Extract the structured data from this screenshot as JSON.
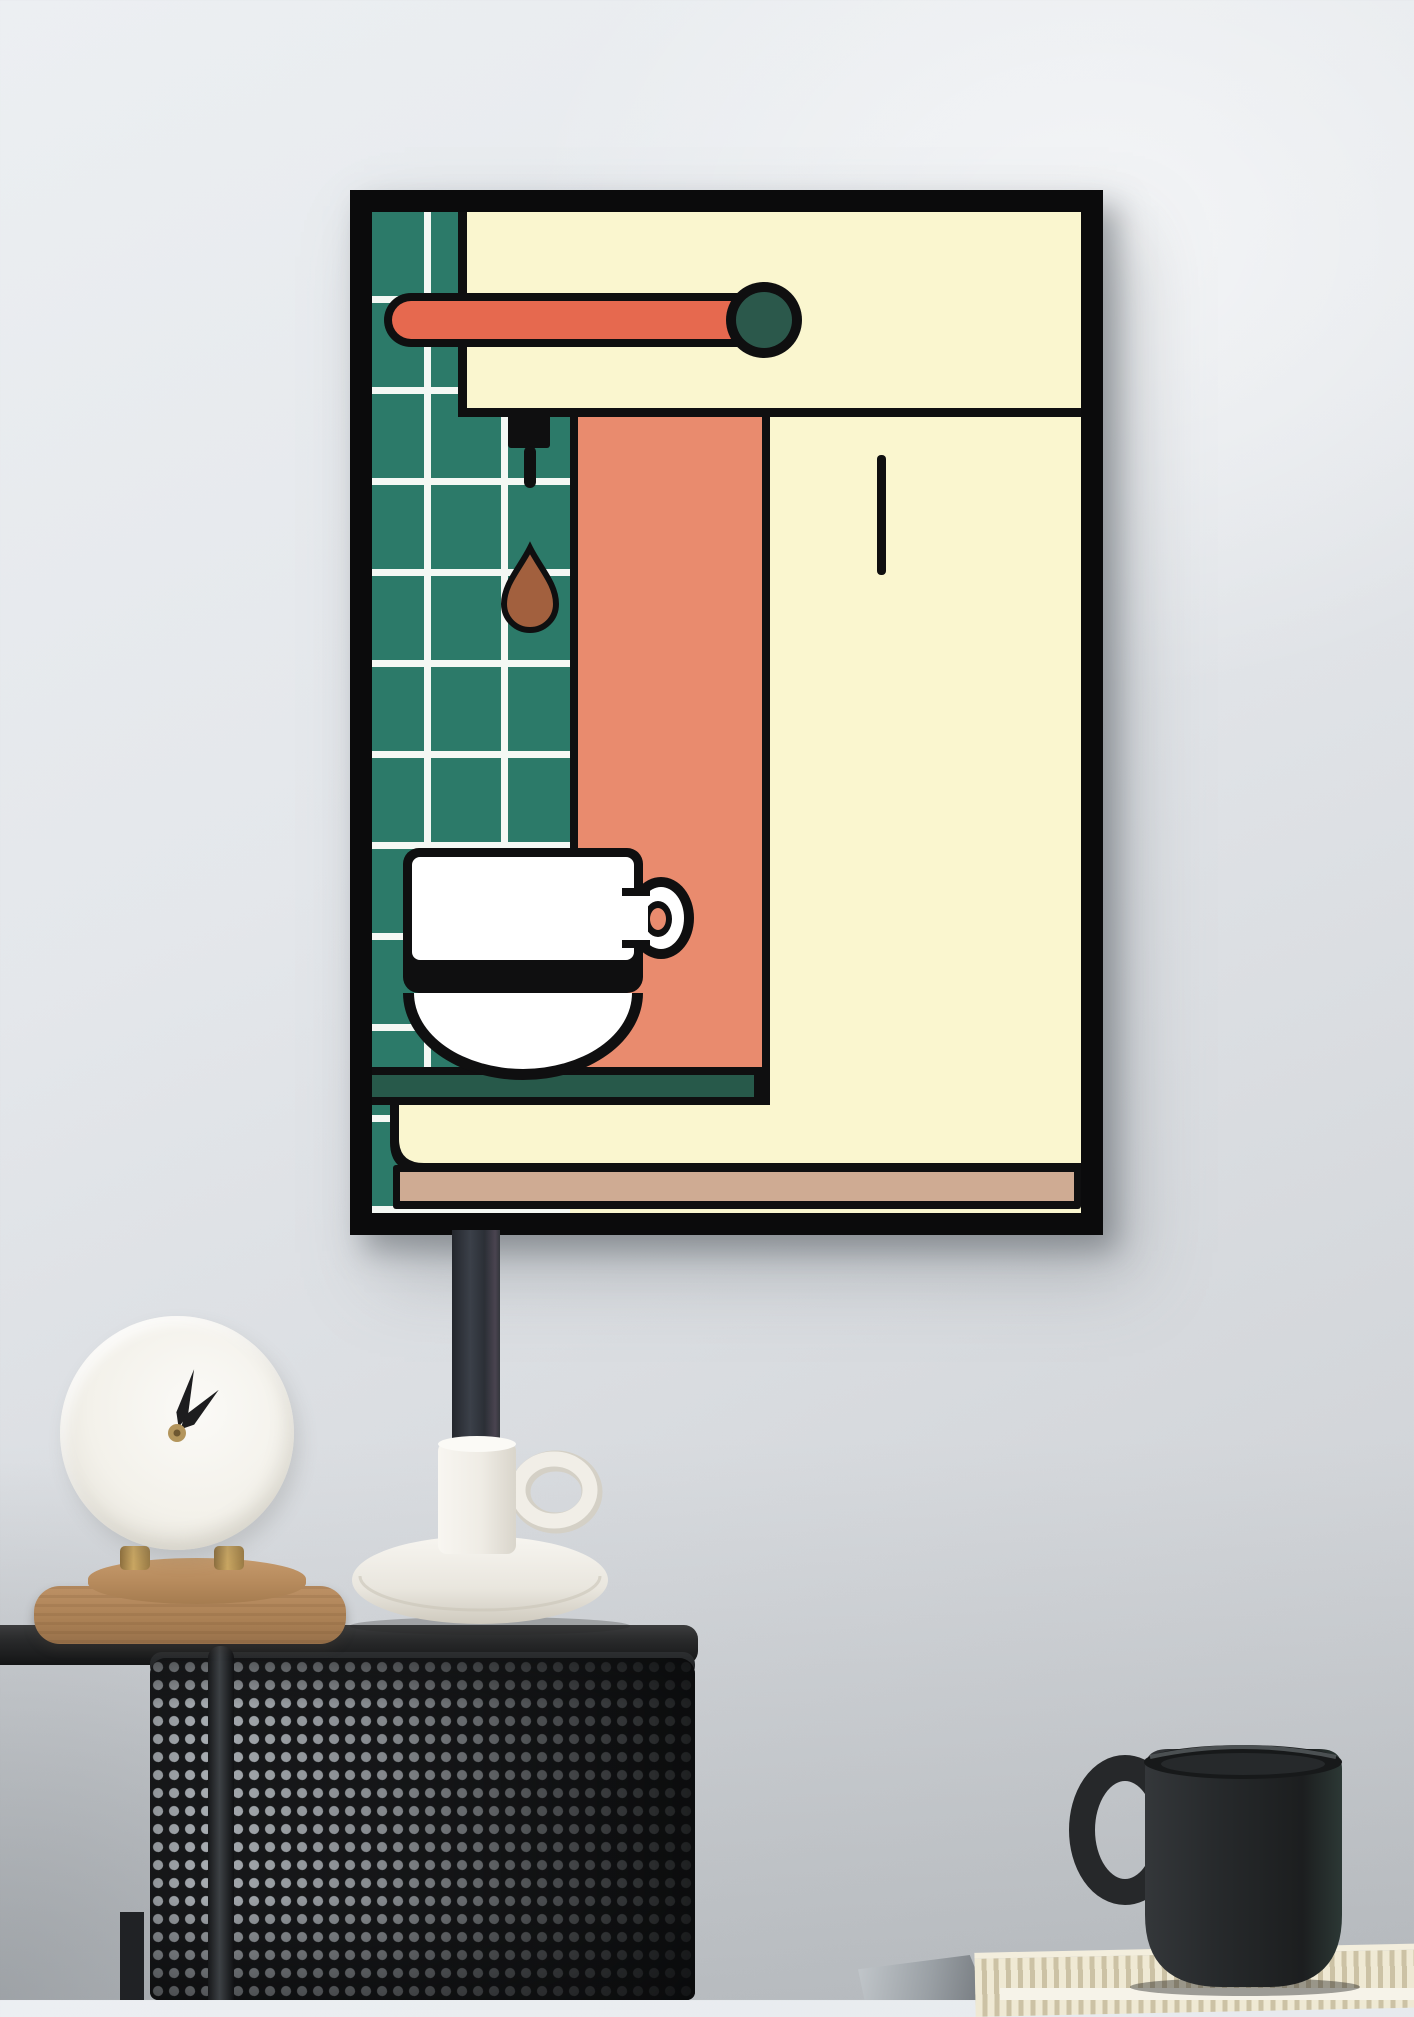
{
  "scene": {
    "type": "photograph",
    "description": "Minimalist espresso-machine art print in a black frame on a light grey wall, above a black perforated-metal side table holding a round marble clock on a wooden pedestal tray and a tall black candle in a white ceramic chamberstick; a black mug sits on a ribbed cream book at lower right",
    "palette": {
      "wall_top": "#eceff2",
      "wall_bottom": "#c9ccd0",
      "frame_black": "#0b0b0c",
      "art_cream": "#faf6cf",
      "art_teal_tile": "#2c7a69",
      "art_grout_white": "#f4f8f4",
      "art_salmon_dark": "#e6694f",
      "art_salmon_light": "#e98b6e",
      "art_knob_teal": "#2b584b",
      "art_tray_green": "#27594a",
      "art_counter_tan": "#cfab93",
      "art_drop_brown": "#a2603e",
      "art_outline": "#0f0f10",
      "art_cup_white": "#ffffff",
      "candle_dark": "#31353d",
      "ceramic_white": "#f2efe8",
      "clock_face": "#f6f4ee",
      "clock_hand": "#1d1d1f",
      "brass": "#b3955c",
      "wood_light": "#bb9064",
      "wood_dark": "#a57c50",
      "table_black": "#1b1d1f",
      "mesh_dot": "#a6abb0",
      "mug_black": "#26282a",
      "book_cream": "#ece5cf",
      "tray_gray": "#94999e"
    }
  },
  "poster": {
    "subject": "espresso machine pouring coffee into a cup",
    "elements": [
      "teal tiled wall",
      "cream machine head",
      "salmon steam lever with dark teal knob",
      "group-head nozzle",
      "falling coffee drop",
      "salmon brew column",
      "white espresso cup",
      "dark green drip tray",
      "cream machine base",
      "tan counter edge"
    ]
  },
  "clock": {
    "style": "round marble desk clock without numerals, brass feet",
    "hands": "both hands pointing upward, roughly 12:05 and toward 1"
  },
  "objects": {
    "candle": "tall matte black taper candle",
    "candle_holder": "white ceramic chamberstick with loop handle and drip dish",
    "wooden_tray": "two-tier round wooden pedestal tray",
    "side_table": "black side table with perforated steel drum base and thin legs",
    "mug": "handmade matte black ceramic mug",
    "book": "cream ribbed hardcover book",
    "metal_tray": "corner of a grey metal tray"
  }
}
